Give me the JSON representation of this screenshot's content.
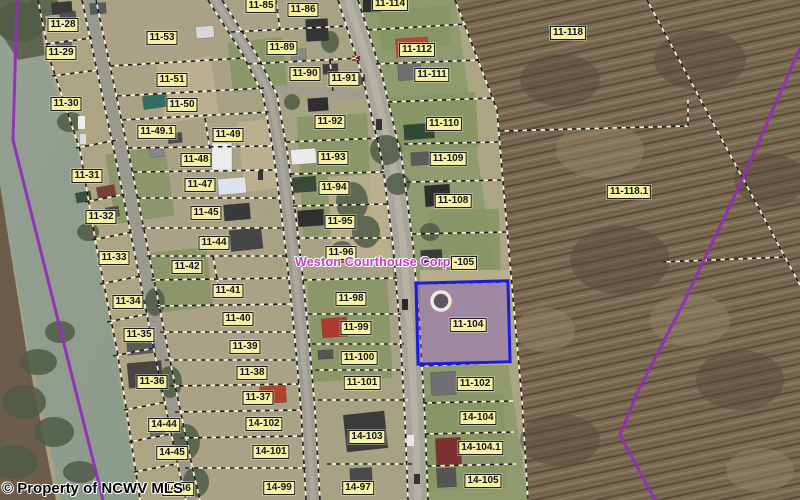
{
  "map": {
    "title": "County parcel map viewer",
    "attribution": "© Property of NCWV MLS",
    "owner_overlay_text": "Weston Courthouse Corp",
    "selected_parcel": "11-104",
    "colors": {
      "selected_border": "#1c1ce0",
      "selected_fill": "rgba(135,95,185,0.5)",
      "label_bg": "#f6f1a4",
      "owner_text": "#c43cc4",
      "boundary_overlay": "#8f2fb8",
      "parcel_line_light": "#fcf7dd",
      "parcel_line_dark": "#1c1c1c"
    },
    "labels": [
      {
        "t": "11-28",
        "x": 63,
        "y": 25
      },
      {
        "t": "11-29",
        "x": 61,
        "y": 53
      },
      {
        "t": "11-30",
        "x": 66,
        "y": 104
      },
      {
        "t": "11-31",
        "x": 87,
        "y": 176
      },
      {
        "t": "11-32",
        "x": 101,
        "y": 217
      },
      {
        "t": "11-33",
        "x": 114,
        "y": 258
      },
      {
        "t": "11-34",
        "x": 128,
        "y": 302
      },
      {
        "t": "11-35",
        "x": 139,
        "y": 335
      },
      {
        "t": "11-36",
        "x": 152,
        "y": 382
      },
      {
        "t": "14-44",
        "x": 164,
        "y": 425
      },
      {
        "t": "14-45",
        "x": 172,
        "y": 453
      },
      {
        "t": "14-46",
        "x": 178,
        "y": 489
      },
      {
        "t": "11-53",
        "x": 162,
        "y": 38
      },
      {
        "t": "11-51",
        "x": 172,
        "y": 80
      },
      {
        "t": "11-50",
        "x": 182,
        "y": 105
      },
      {
        "t": "11-49.1",
        "x": 157,
        "y": 132
      },
      {
        "t": "11-49",
        "x": 228,
        "y": 135
      },
      {
        "t": "11-48",
        "x": 196,
        "y": 160
      },
      {
        "t": "11-47",
        "x": 200,
        "y": 185
      },
      {
        "t": "11-45",
        "x": 206,
        "y": 213
      },
      {
        "t": "11-44",
        "x": 214,
        "y": 243
      },
      {
        "t": "11-42",
        "x": 187,
        "y": 267
      },
      {
        "t": "11-41",
        "x": 228,
        "y": 291
      },
      {
        "t": "11-40",
        "x": 238,
        "y": 319
      },
      {
        "t": "11-39",
        "x": 245,
        "y": 347
      },
      {
        "t": "11-38",
        "x": 252,
        "y": 373
      },
      {
        "t": "11-37",
        "x": 258,
        "y": 398
      },
      {
        "t": "14-102",
        "x": 264,
        "y": 424
      },
      {
        "t": "14-101",
        "x": 271,
        "y": 452
      },
      {
        "t": "14-99",
        "x": 279,
        "y": 488
      },
      {
        "t": "11-85",
        "x": 261,
        "y": 6
      },
      {
        "t": "11-86",
        "x": 303,
        "y": 10
      },
      {
        "t": "11-89",
        "x": 282,
        "y": 48
      },
      {
        "t": "11-90",
        "x": 305,
        "y": 74
      },
      {
        "t": "11-91",
        "x": 344,
        "y": 79
      },
      {
        "t": "11-92",
        "x": 330,
        "y": 122
      },
      {
        "t": "11-93",
        "x": 333,
        "y": 158
      },
      {
        "t": "11-94",
        "x": 334,
        "y": 188
      },
      {
        "t": "11-95",
        "x": 340,
        "y": 222
      },
      {
        "t": "11-96",
        "x": 341,
        "y": 253
      },
      {
        "t": "11-98",
        "x": 351,
        "y": 299
      },
      {
        "t": "11-99",
        "x": 356,
        "y": 328
      },
      {
        "t": "11-100",
        "x": 359,
        "y": 358
      },
      {
        "t": "11-101",
        "x": 362,
        "y": 383
      },
      {
        "t": "14-103",
        "x": 367,
        "y": 437
      },
      {
        "t": "14-97",
        "x": 358,
        "y": 488
      },
      {
        "t": "11-114",
        "x": 390,
        "y": 4
      },
      {
        "t": "11-112",
        "x": 417,
        "y": 50
      },
      {
        "t": "11-111",
        "x": 432,
        "y": 75
      },
      {
        "t": "11-110",
        "x": 444,
        "y": 124
      },
      {
        "t": "11-109",
        "x": 448,
        "y": 159
      },
      {
        "t": "11-108",
        "x": 453,
        "y": 201
      },
      {
        "t": "-105",
        "x": 464,
        "y": 263
      },
      {
        "t": "11-104",
        "x": 468,
        "y": 325
      },
      {
        "t": "11-102",
        "x": 475,
        "y": 384
      },
      {
        "t": "14-104",
        "x": 478,
        "y": 418
      },
      {
        "t": "14-104.1",
        "x": 481,
        "y": 448
      },
      {
        "t": "14-105",
        "x": 483,
        "y": 481
      },
      {
        "t": "11-118",
        "x": 568,
        "y": 33
      },
      {
        "t": "11-118.1",
        "x": 629,
        "y": 192
      }
    ]
  }
}
